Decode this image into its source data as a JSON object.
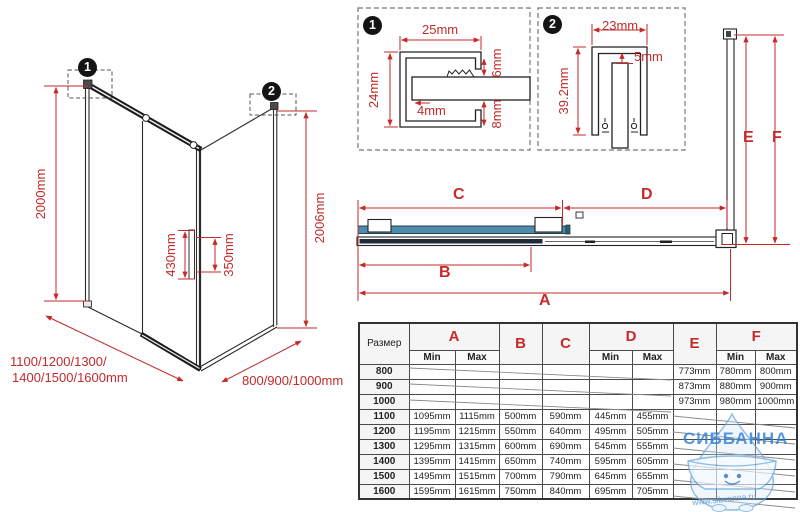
{
  "watermark": {
    "title": "СИББАННА",
    "url": "www.sibvanna.ru"
  },
  "iso": {
    "callout1": "1",
    "callout2": "2",
    "height_left": "2000mm",
    "height_right": "2006mm",
    "handle_height": "430mm",
    "handle_spacing": "350mm",
    "width_options_line1": "1100/1200/1300/",
    "width_options_line2": "1400/1500/1600mm",
    "depth_options": "800/900/1000mm"
  },
  "detail1": {
    "badge": "1",
    "width": "25mm",
    "height": "24mm",
    "glass": "4mm",
    "top_gap": "6mm",
    "bottom_gap": "8mm"
  },
  "detail2": {
    "badge": "2",
    "width": "23mm",
    "gap": "5mm",
    "height": "39.2mm"
  },
  "section": {
    "a": "A",
    "b": "B",
    "c": "C",
    "d": "D",
    "e": "E",
    "f": "F"
  },
  "table": {
    "size_header": "Размер",
    "min": "Min",
    "max": "Max",
    "letters": {
      "a": "A",
      "b": "B",
      "c": "C",
      "d": "D",
      "e": "E",
      "f": "F"
    },
    "rows": [
      {
        "size": "800",
        "a_min": "",
        "a_max": "",
        "b": "",
        "c": "",
        "d_min": "",
        "d_max": "",
        "e": "773mm",
        "f_min": "780mm",
        "f_max": "800mm"
      },
      {
        "size": "900",
        "a_min": "",
        "a_max": "",
        "b": "",
        "c": "",
        "d_min": "",
        "d_max": "",
        "e": "873mm",
        "f_min": "880mm",
        "f_max": "900mm"
      },
      {
        "size": "1000",
        "a_min": "",
        "a_max": "",
        "b": "",
        "c": "",
        "d_min": "",
        "d_max": "",
        "e": "973mm",
        "f_min": "980mm",
        "f_max": "1000mm"
      },
      {
        "size": "1100",
        "a_min": "1095mm",
        "a_max": "1115mm",
        "b": "500mm",
        "c": "590mm",
        "d_min": "445mm",
        "d_max": "455mm",
        "e": "",
        "f_min": "",
        "f_max": ""
      },
      {
        "size": "1200",
        "a_min": "1195mm",
        "a_max": "1215mm",
        "b": "550mm",
        "c": "640mm",
        "d_min": "495mm",
        "d_max": "505mm",
        "e": "",
        "f_min": "",
        "f_max": ""
      },
      {
        "size": "1300",
        "a_min": "1295mm",
        "a_max": "1315mm",
        "b": "600mm",
        "c": "690mm",
        "d_min": "545mm",
        "d_max": "555mm",
        "e": "",
        "f_min": "",
        "f_max": ""
      },
      {
        "size": "1400",
        "a_min": "1395mm",
        "a_max": "1415mm",
        "b": "650mm",
        "c": "740mm",
        "d_min": "595mm",
        "d_max": "605mm",
        "e": "",
        "f_min": "",
        "f_max": ""
      },
      {
        "size": "1500",
        "a_min": "1495mm",
        "a_max": "1515mm",
        "b": "700mm",
        "c": "790mm",
        "d_min": "645mm",
        "d_max": "655mm",
        "e": "",
        "f_min": "",
        "f_max": ""
      },
      {
        "size": "1600",
        "a_min": "1595mm",
        "a_max": "1615mm",
        "b": "750mm",
        "c": "840mm",
        "d_min": "695mm",
        "d_max": "705mm",
        "e": "",
        "f_min": "",
        "f_max": ""
      }
    ]
  },
  "colors": {
    "dimension_red": "#c42a2a",
    "glass_teal": "#4d8cab",
    "profile_navy": "#1f2b38",
    "watermark_blue": "#2f7fd6"
  }
}
